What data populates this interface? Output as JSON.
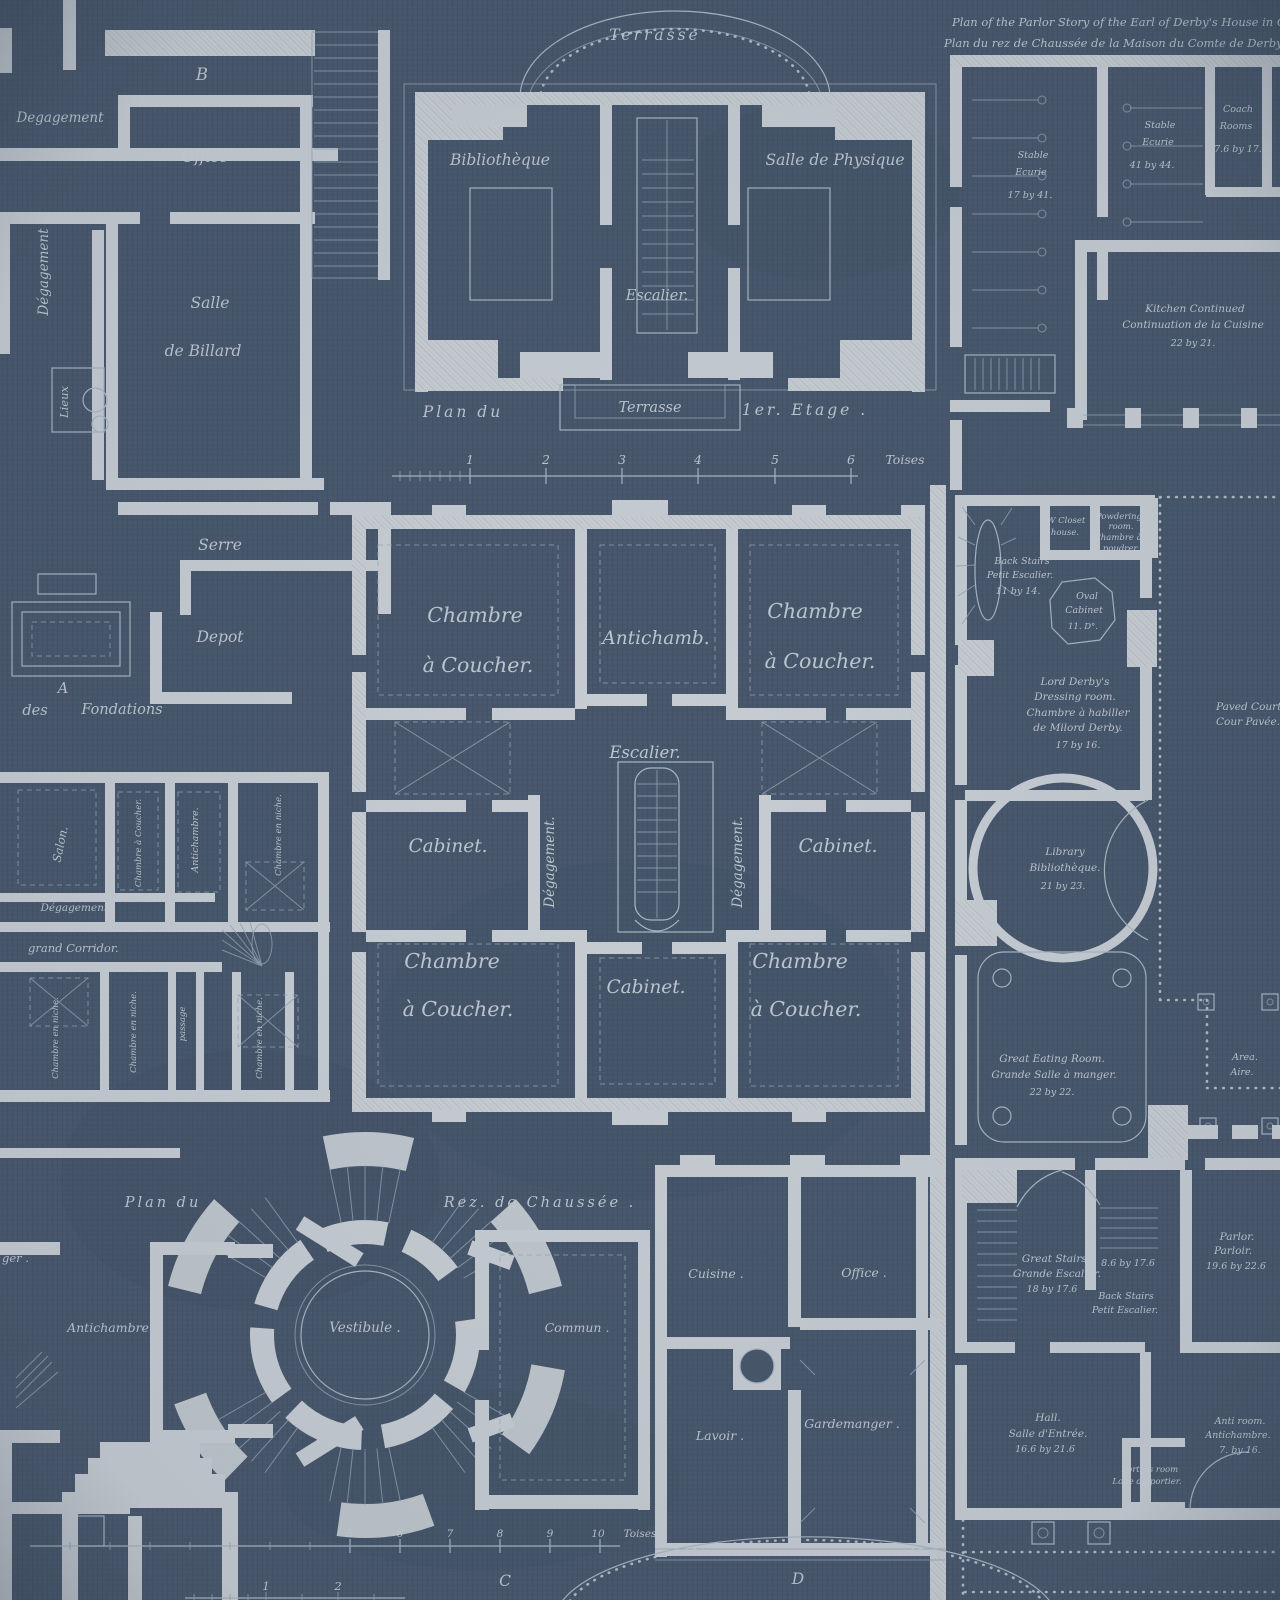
{
  "palette": {
    "background": "#475669",
    "wall": "#c7cdd3",
    "line": "#a8b6c4",
    "text": "#c8d1da"
  },
  "header": {
    "title_en": "Plan of the Parlor Story of the Earl of Derby's House in Grosv",
    "title_fr": "Plan du rez de Chaussée de la Maison du Comte de Derby dans le Qua"
  },
  "top_left": {
    "letter_b": "B",
    "degagement": "Degagement",
    "office": "Office",
    "degagement_v": "Dégagement",
    "salle": "Salle",
    "de_billard": "de Billard",
    "lieux": "Lieux",
    "serre": "Serre",
    "depot": "Depot",
    "letter_a": "A",
    "des": "des",
    "fondations": "Fondations"
  },
  "pavilion": {
    "terrasse_top": "Terrasse",
    "bibliotheque": "Bibliothèque",
    "salle_physique": "Salle de Physique",
    "escalier": "Escalier.",
    "terrasse_bottom": "Terrasse",
    "plan_du": "Plan du",
    "etage": "1er. Etage .",
    "scale": {
      "n1": "1",
      "n2": "2",
      "n3": "3",
      "n4": "4",
      "n5": "5",
      "n6": "6",
      "unit": "Toises"
    }
  },
  "stables": {
    "stable_a": "Stable",
    "stable_b": "Ecurie",
    "stable1_size": "17 by 41.",
    "stable2_size": "41 by 44.",
    "coach_a": "Coach",
    "coach_b": "Rooms",
    "coach_size": "7.6 by 17.6",
    "kitchen_a": "Kitchen Continued",
    "kitchen_b": "Continuation de la Cuisine",
    "kitchen_size": "22 by 21."
  },
  "central": {
    "chambre": "Chambre",
    "a_coucher": "à Coucher.",
    "antichamb": "Antichamb.",
    "escalier": "Escalier.",
    "cabinet": "Cabinet.",
    "degagement": "Dégagement."
  },
  "mini_plan": {
    "salon": "Salon.",
    "chambre_a_coucher": "Chambre à Coucher.",
    "antichambre": "Antichambre.",
    "chambre_en_niche": "Chambre en niche.",
    "degagement": "Dégagement.",
    "grand_corridor": "grand Corridor.",
    "passage": "passage"
  },
  "derby": {
    "back_stairs_a": "Back Stairs",
    "back_stairs_b": "Petit Escalier.",
    "back_stairs1_size": "11 by 14.",
    "w_closet_a": "W Closet",
    "w_closet_b": "house.",
    "powdering_a": "Powdering",
    "powdering_b": "room.",
    "powdering_c": "Chambre à",
    "powdering_d": "poudrer.",
    "oval_a": "Oval",
    "oval_b": "Cabinet",
    "oval_size": "11. D°.",
    "dressing_a": "Lord Derby's",
    "dressing_b": "Dressing room.",
    "dressing_c": "Chambre à habiller",
    "dressing_d": "de Milord Derby.",
    "dressing_size": "17 by 16.",
    "paved_court_en": "Paved Court",
    "paved_court_fr": "Cour Pavée.",
    "library_a": "Library",
    "library_b": "Bibliothèque.",
    "library_size": "21 by 23.",
    "eating_a": "Great Eating Room.",
    "eating_b": "Grande Salle à manger.",
    "eating_size": "22 by 22.",
    "area_en": "Area.",
    "area_fr": "Aire.",
    "great_stairs_a": "Great Stairs.",
    "great_stairs_b": "Grande Escalier.",
    "great_stairs_size": "18 by 17.6",
    "back_stairs2_size": "8.6 by 17.6",
    "parlor_a": "Parlor.",
    "parlor_b": "Parloir.",
    "parlor_size": "19.6 by 22.6",
    "hall_a": "Hall.",
    "hall_b": "Salle d'Entrée.",
    "hall_size": "16.6 by 21.6",
    "anti_a": "Anti room.",
    "anti_b": "Antichambre.",
    "anti_size": "7. by 16.",
    "porters_a": "Porters room",
    "porters_b": "Loge du portier."
  },
  "ground": {
    "plan_du": "Plan du",
    "rez": "Rez. de Chaussée .",
    "vestibule": "Vestibule .",
    "antichambre": "Antichambre .",
    "ger_fragment": "ger .",
    "commun": "Commun .",
    "cuisine": "Cuisine .",
    "office": "Office .",
    "lavoir": "Lavoir .",
    "gardemanger": "Gardemanger .",
    "section_c": "C",
    "section_d": "D",
    "scale_mid": {
      "n5": "5",
      "n6": "6",
      "n7": "7",
      "n8": "8",
      "n9": "9",
      "n10": "10",
      "unit": "Toises"
    },
    "scale_small": {
      "n1": "1",
      "n2": "2"
    }
  }
}
